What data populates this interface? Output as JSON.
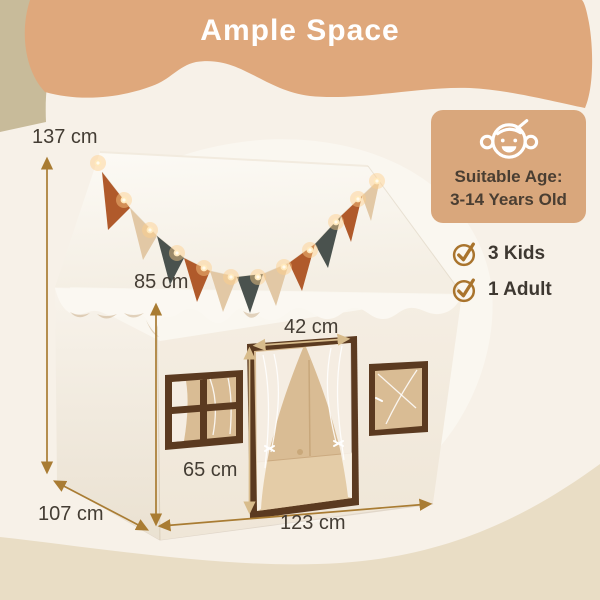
{
  "header": {
    "title": "Ample Space"
  },
  "age_card": {
    "icon": "baby-face-icon",
    "lines": [
      "Suitable Age:",
      "3-14 Years Old"
    ]
  },
  "capacity": {
    "items": [
      {
        "icon": "check-circle-icon",
        "label": "3 Kids"
      },
      {
        "icon": "check-circle-icon",
        "label": "1 Adult"
      }
    ]
  },
  "dimensions": {
    "overall_height": "137 cm",
    "wall_height": "85 cm",
    "door_width": "42 cm",
    "door_height": "65 cm",
    "depth": "107 cm",
    "width": "123 cm"
  },
  "colors": {
    "banner_tan": "#DFA87C",
    "background_cream": "#F7F1E8",
    "corner_khaki": "#C8BB9A",
    "bottom_band_beige": "#E9DDC5",
    "card_tan": "#D9A77C",
    "text_dark": "#443D34",
    "title_white": "#FFFFFF",
    "arrow_amber": "#A97C33",
    "arrow_gold": "#D8BC8C",
    "check_brown": "#A9742D",
    "flag_rust": "#B05A2B",
    "flag_beige": "#E2C8A5",
    "flag_charcoal": "#4A524E",
    "tent_white": "#FAF7F1",
    "frame_brown": "#5B3A20",
    "interior_tan": "#D9BC94"
  }
}
